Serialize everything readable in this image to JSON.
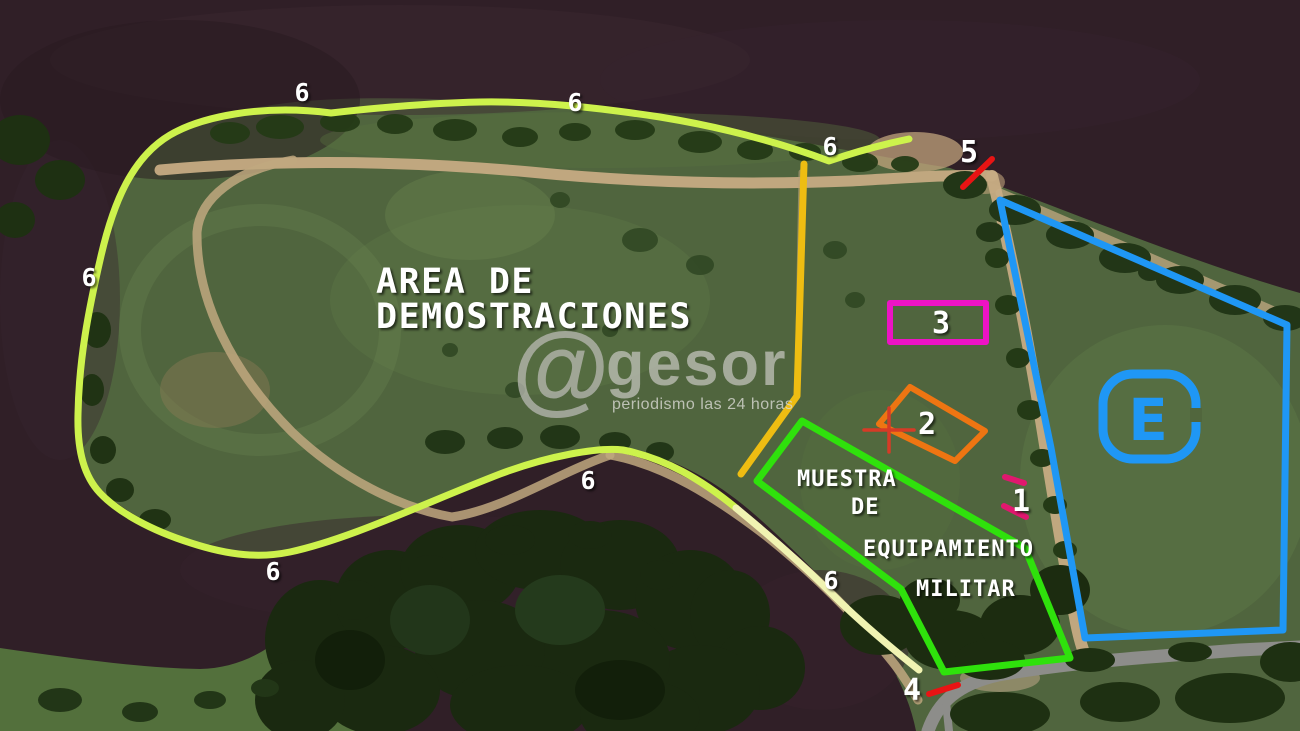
{
  "map": {
    "title_line1": "AREA DE",
    "title_line2": "DEMOSTRACIONES",
    "equipment_zone": {
      "line1": "MUESTRA",
      "line2": "DE",
      "line3": "EQUIPAMIENTO",
      "line4": "MILITAR"
    },
    "parking_symbol": "E",
    "route_markers": [
      "6",
      "6",
      "6",
      "6",
      "6",
      "6",
      "6"
    ],
    "numbered_points": {
      "p1": "1",
      "p2": "2",
      "p3": "3",
      "p4": "4",
      "p5": "5"
    },
    "colors": {
      "route": "#cdf24c",
      "route_pale": "#f0f3b2",
      "trail": "#eebd12",
      "equipment_zone": "#2fe10c",
      "parking_zone": "#1f97f5",
      "zone3": "#ec13c4",
      "zone2": "#ee7512",
      "marker_tick": "#e81414",
      "point1_dash": "#e0186e",
      "crosshair": "#d63b26",
      "label": "#ffffff"
    }
  },
  "watermark": {
    "symbol": "@",
    "brand": "gesor",
    "tagline": "periodismo las 24 horas"
  }
}
